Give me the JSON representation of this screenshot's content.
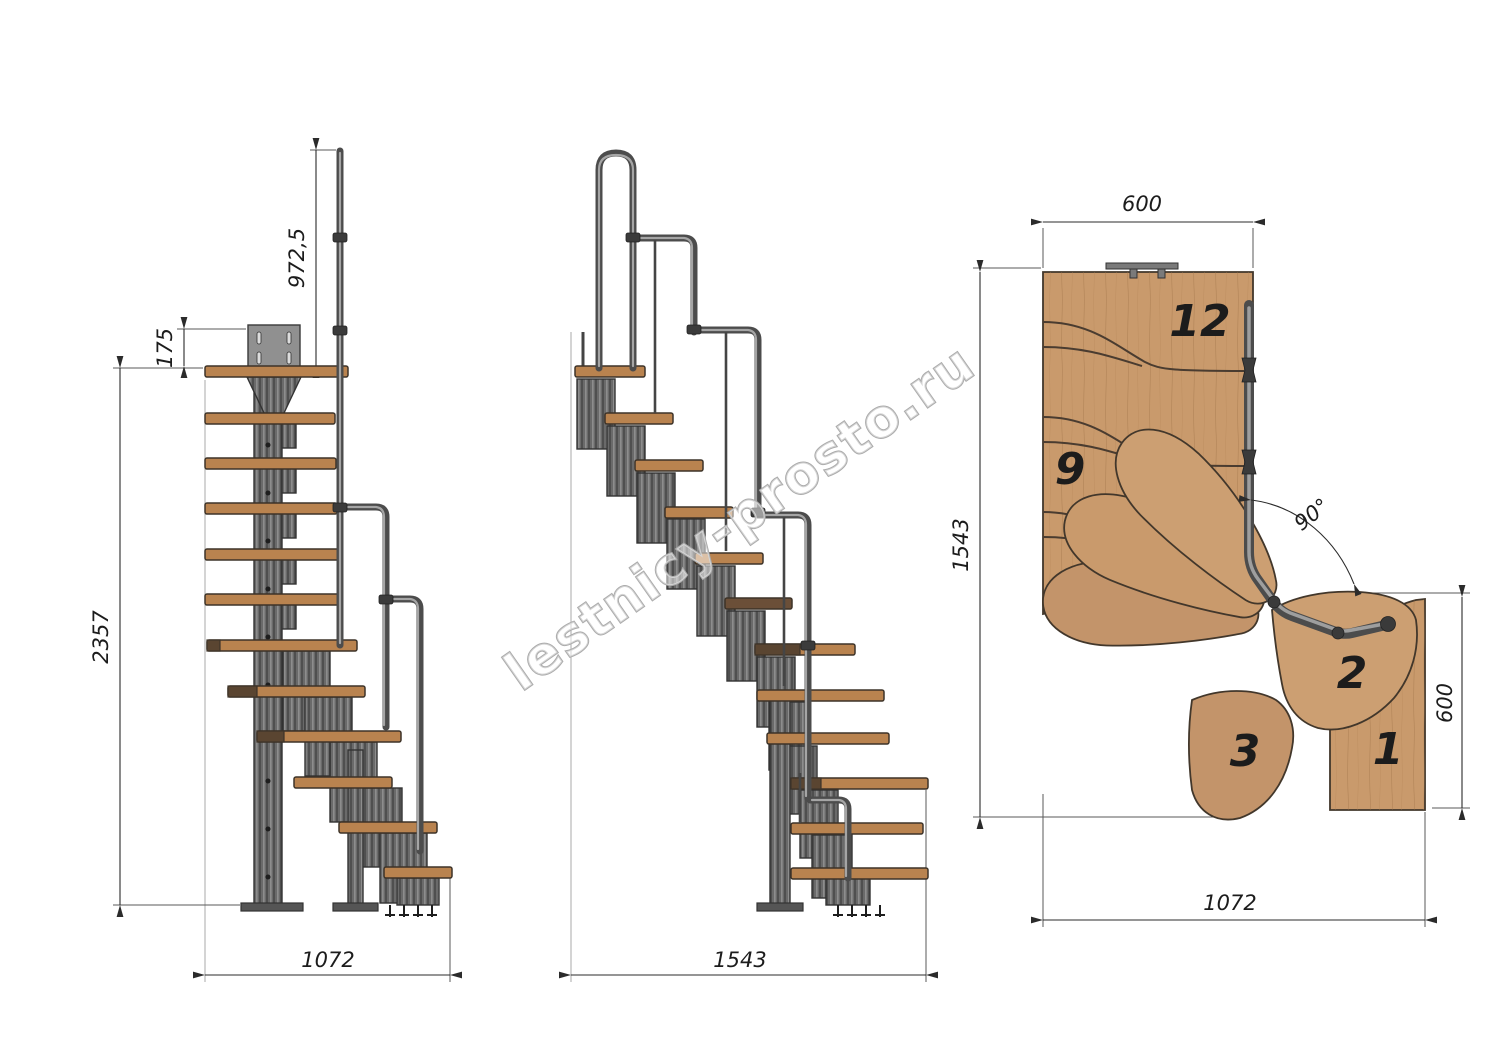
{
  "watermark": {
    "text": "lestnicy-prosto.ru"
  },
  "view_side_a": {
    "dim_rail_height": "972,5",
    "dim_plate_offset": "175",
    "dim_total_height": "2357",
    "dim_base_width": "1072"
  },
  "view_side_b": {
    "dim_base_width": "1543"
  },
  "view_plan": {
    "dim_top_width": "600",
    "dim_side_length": "1543",
    "dim_right_width": "600",
    "dim_bottom_width": "1072",
    "dim_turn_angle": "90°",
    "step_numbers": {
      "n12": "12",
      "n9": "9",
      "n3": "3",
      "n2": "2",
      "n1": "1"
    }
  },
  "colors": {
    "wood": "#c99a6c",
    "tread_wood": "#b9834f",
    "dark_wood": "#5a4531",
    "metal_module": "#6a6a6a",
    "rail_metal": "#4c4c4c",
    "dimension_line": "#2b2b2b",
    "watermark_outline": "#ababab",
    "background": "#ffffff"
  }
}
